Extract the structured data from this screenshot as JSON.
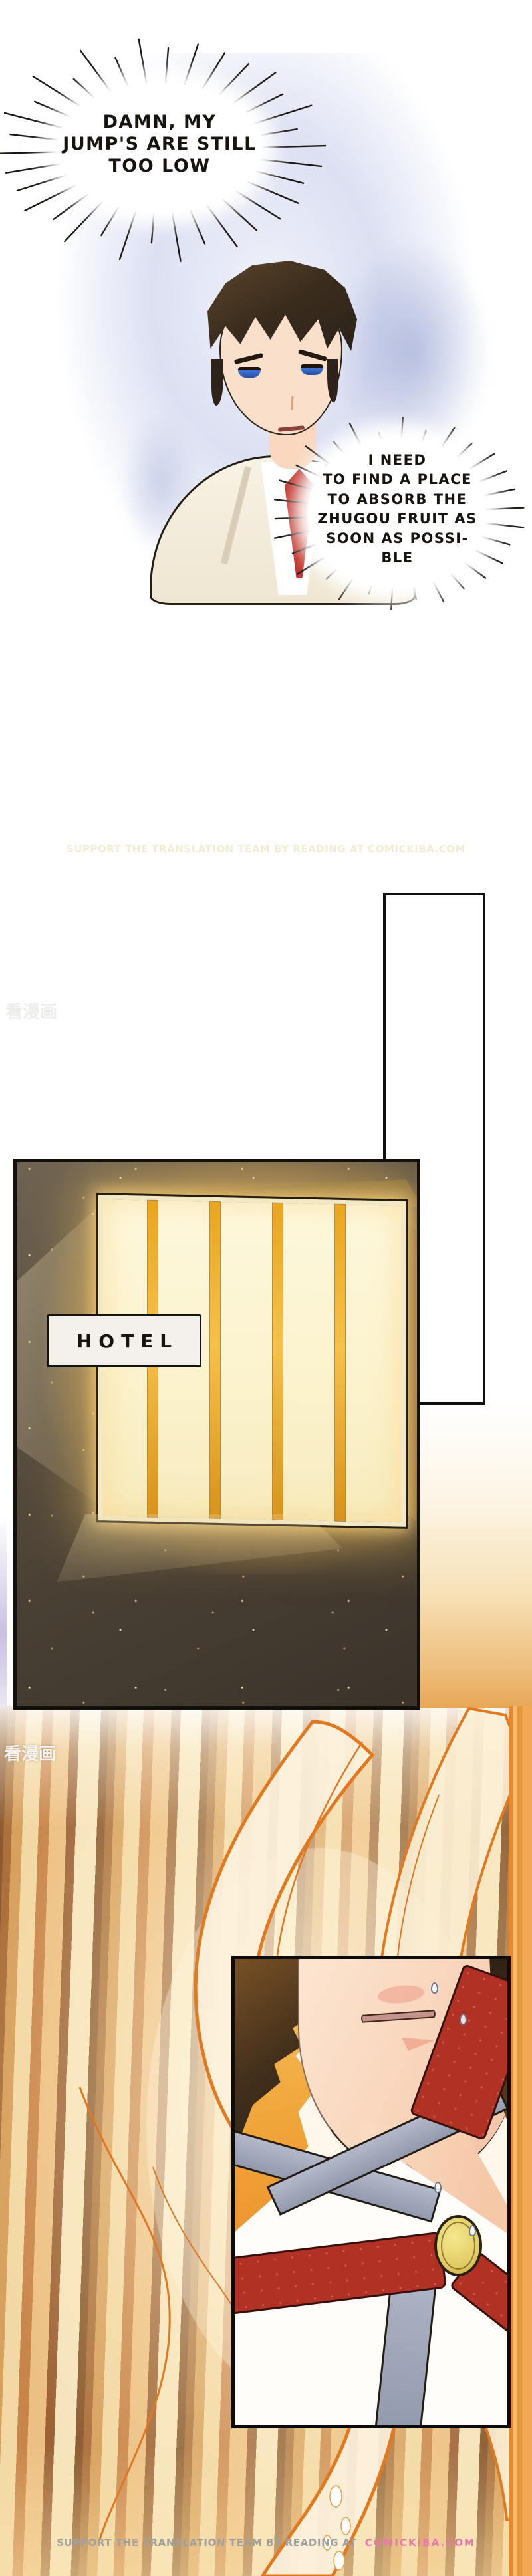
{
  "bubbles": {
    "b1": {
      "lines": [
        "DAMN, MY",
        "JUMP'S ARE STILL",
        "TOO LOW"
      ]
    },
    "b2": {
      "lines": [
        "I NEED",
        "TO FIND A PLACE",
        "TO ABSORB THE",
        "ZHUGOU FRUIT AS",
        "SOON AS POSSI-",
        "BLE"
      ]
    }
  },
  "hotel": {
    "sign": "HOTEL"
  },
  "marks": {
    "translation_note": "SUPPORT THE TRANSLATION TEAM BY READING AT COMICKIBA.COM",
    "cn_watermark": "看漫画"
  },
  "footer": {
    "prefix": "SUPPORT THE TRANSLATION TEAM BY READING AT",
    "site": "COMICKIBA.COM"
  },
  "colors": {
    "flame_orange": "#e07722",
    "flame_cream": "#fcf1dc",
    "window_glow": "#fbf4d3",
    "mullion_orange": "#e9a51f",
    "scarf_red": "#b23125",
    "brooch_gold": "#e3cd67",
    "footer_gray": "#a0a09e",
    "footer_pink": "#e878ad",
    "panel_border": "#0d0c0a"
  }
}
